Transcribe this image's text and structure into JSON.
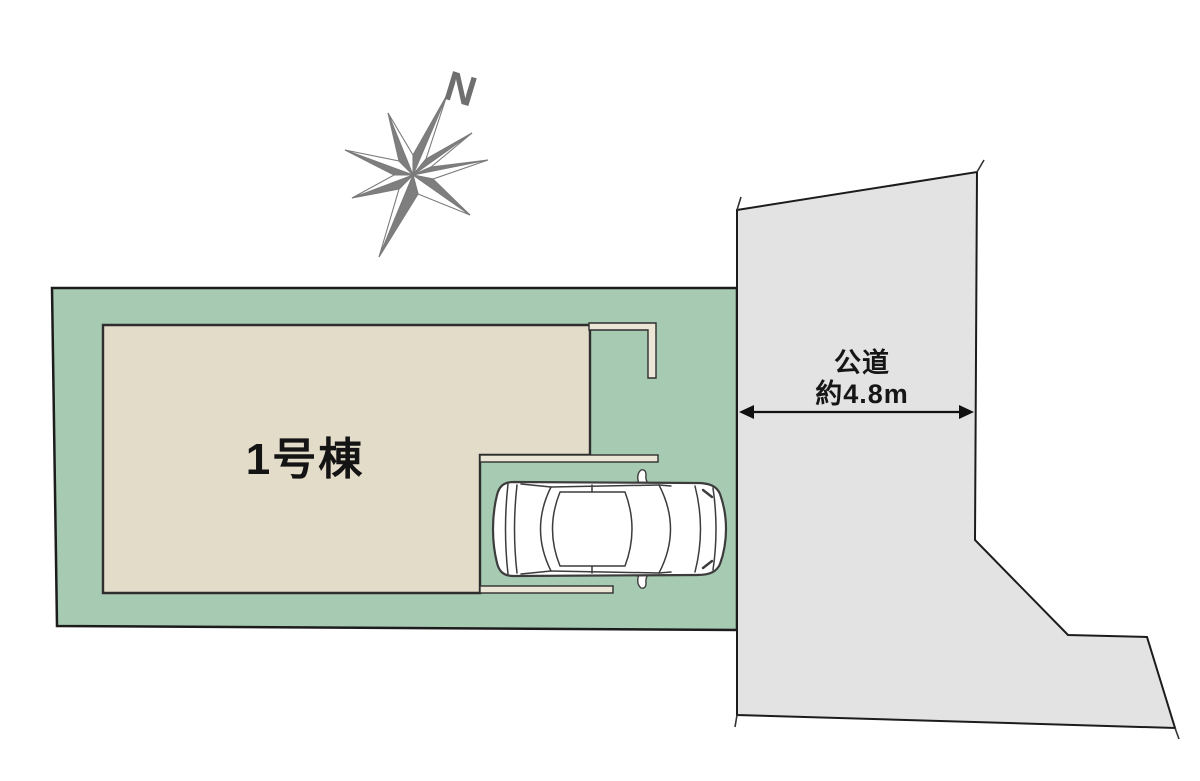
{
  "canvas": {
    "width": 1200,
    "height": 781,
    "background": "#ffffff"
  },
  "compass": {
    "north_label": "N",
    "star_dark": "#7e7e7e",
    "star_light": "#ffffff"
  },
  "lot": {
    "fill": "#a7cab2",
    "border": "#1c1c1c"
  },
  "building": {
    "label": "1号棟",
    "fill": "#e2dcc9",
    "eave_fill": "#ece6d6",
    "border": "#2e2e2e"
  },
  "road": {
    "name_label": "公道",
    "width_label": "約4.8m",
    "fill": "#e3e3e4",
    "border": "#1c1c1c"
  },
  "car": {
    "fill": "#ffffff",
    "stroke": "#3c3c3c"
  },
  "dimension": {
    "arrow_color": "#111111"
  }
}
